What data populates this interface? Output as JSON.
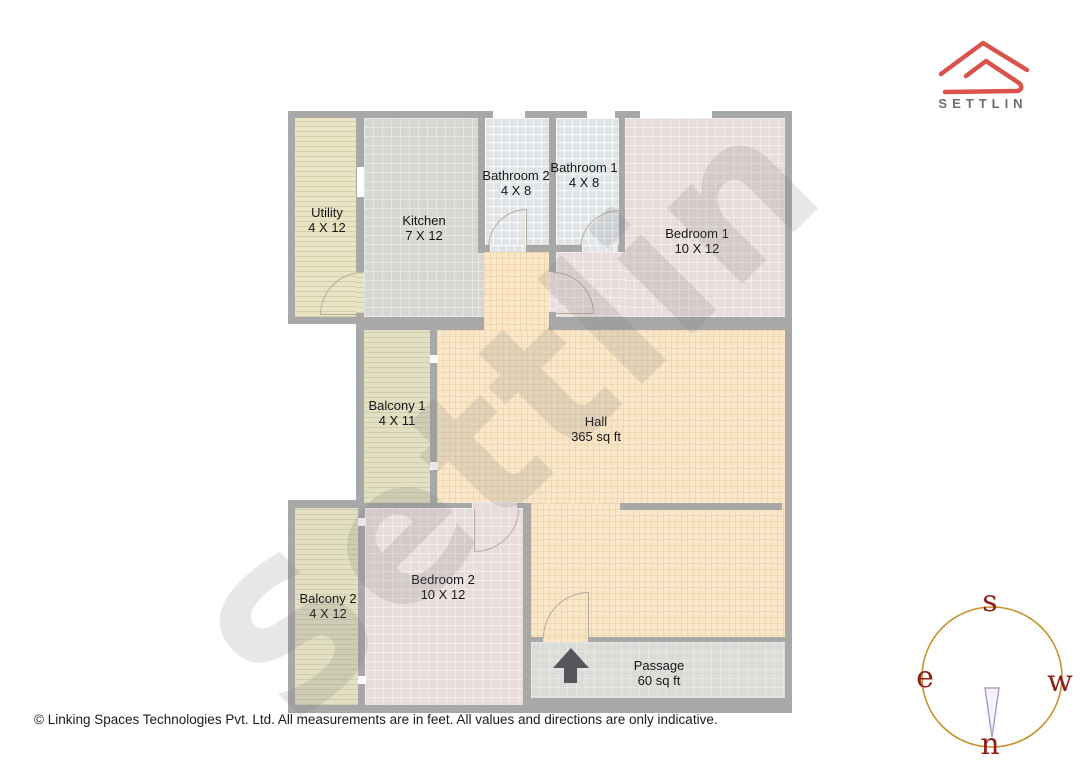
{
  "logo": {
    "brand": "SETTLIN",
    "accent_color": "#d9534c",
    "text_color": "#6f6f6f"
  },
  "watermark": {
    "text": "Settlin"
  },
  "rooms": [
    {
      "id": "utility",
      "name": "Utility",
      "dims": "4 X 12"
    },
    {
      "id": "kitchen",
      "name": "Kitchen",
      "dims": "7 X 12"
    },
    {
      "id": "bathroom2",
      "name": "Bathroom 2",
      "dims": "4 X 8"
    },
    {
      "id": "bathroom1",
      "name": "Bathroom 1",
      "dims": "4 X 8"
    },
    {
      "id": "bedroom1",
      "name": "Bedroom 1",
      "dims": "10 X 12"
    },
    {
      "id": "balcony1",
      "name": "Balcony 1",
      "dims": "4 X 11"
    },
    {
      "id": "hall",
      "name": "Hall",
      "dims": "365 sq ft"
    },
    {
      "id": "bedroom2",
      "name": "Bedroom 2",
      "dims": "10 X 12"
    },
    {
      "id": "balcony2",
      "name": "Balcony 2",
      "dims": "4 X 12"
    },
    {
      "id": "passage",
      "name": "Passage",
      "dims": "60 sq ft"
    }
  ],
  "compass": {
    "top": "s",
    "left": "e",
    "right": "w",
    "bottom": "n",
    "circle_color": "#c8922f",
    "letter_color": "#8e1f16",
    "needle_color": "#b49bc8"
  },
  "footer": {
    "text": "© Linking Spaces Technologies Pvt. Ltd. All measurements are in feet. All values and directions are only indicative."
  }
}
